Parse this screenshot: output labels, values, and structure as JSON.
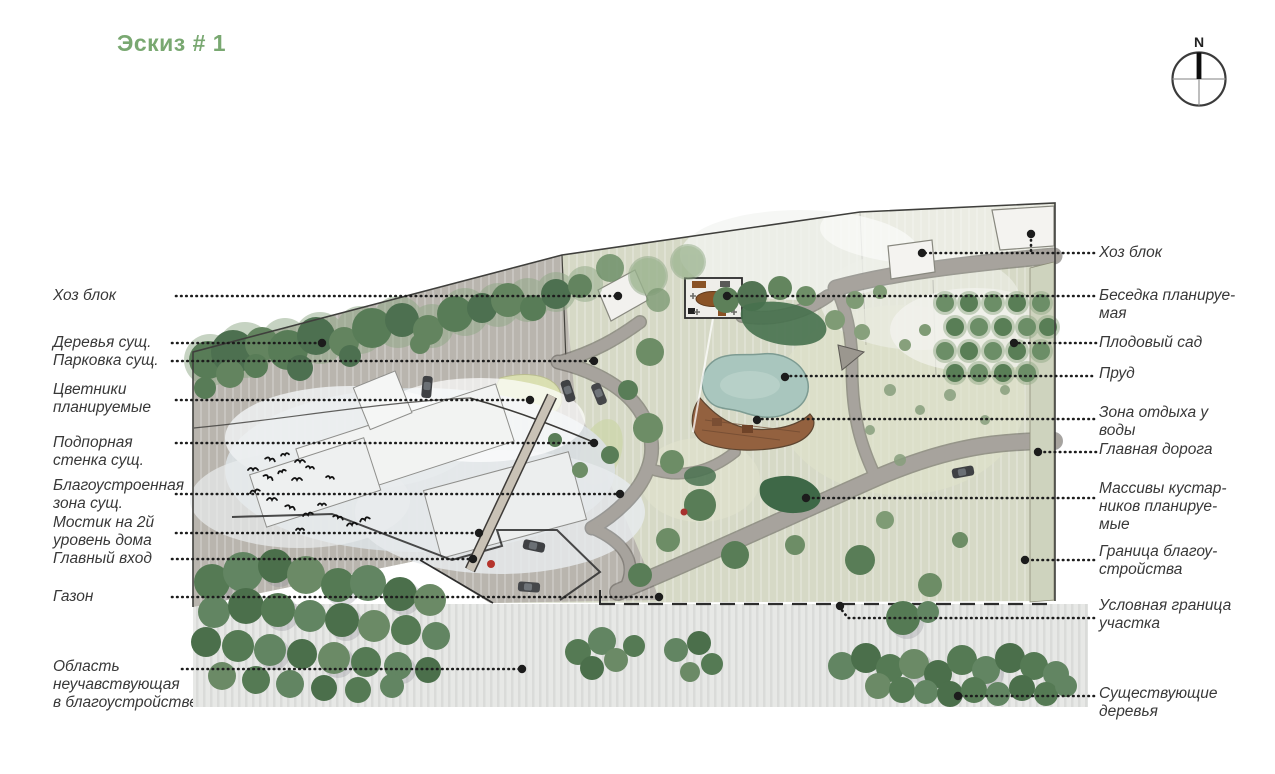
{
  "title": "Эскиз # 1",
  "compass": {
    "north_label": "N"
  },
  "colors": {
    "title_green": "#79a871",
    "label_text": "#383838",
    "leader_line": "#1c1c1c",
    "pond": "#a9c6be",
    "deck_wood": "#93613f",
    "tree_dark": "#587c57",
    "paving_gray": "#b9b5ae",
    "lawn": "#d6d9c6"
  },
  "labels_left": [
    {
      "id": "hoz-blok",
      "text": "Хоз блок"
    },
    {
      "id": "derevya-sushch",
      "text": "Деревья сущ."
    },
    {
      "id": "parkovka-sushch",
      "text": "Парковка сущ."
    },
    {
      "id": "cvetniki-planiruemye",
      "text": "Цветники\nпланируемые"
    },
    {
      "id": "podpornaya-stenka",
      "text": "Подпорная\nстенка сущ."
    },
    {
      "id": "blagoustroennaya-zona",
      "text": "Благоустроенная\nзона сущ."
    },
    {
      "id": "mostik",
      "text": "Мостик на 2й\nуровень дома"
    },
    {
      "id": "glavnyj-vhod",
      "text": "Главный вход"
    },
    {
      "id": "gazon",
      "text": "Газон"
    },
    {
      "id": "oblast-ne-uchastvuyushchaya",
      "text": "Область\nнеучавствующая\nв благоустройстве"
    }
  ],
  "labels_right": [
    {
      "id": "hoz-blok",
      "text": "Хоз блок"
    },
    {
      "id": "besedka-planiruemaya",
      "text": "Беседка планируе-\nмая"
    },
    {
      "id": "plodovyj-sad",
      "text": "Плодовый сад"
    },
    {
      "id": "prud",
      "text": "Пруд"
    },
    {
      "id": "zona-otdyha-u-vody",
      "text": "Зона отдыха у\nводы"
    },
    {
      "id": "glavnaya-doroga",
      "text": "Главная дорога"
    },
    {
      "id": "massivy-kustarnikov",
      "text": "Массивы кустар-\nников планируе-\nмые"
    },
    {
      "id": "granica-blagoustrojstva",
      "text": "Граница благоу-\nстройства"
    },
    {
      "id": "uslovnaya-granica-uchastka",
      "text": "Условная граница\nучастка"
    },
    {
      "id": "sushchestvuyushchie-derevya",
      "text": "Существующие\nдеревья"
    }
  ]
}
